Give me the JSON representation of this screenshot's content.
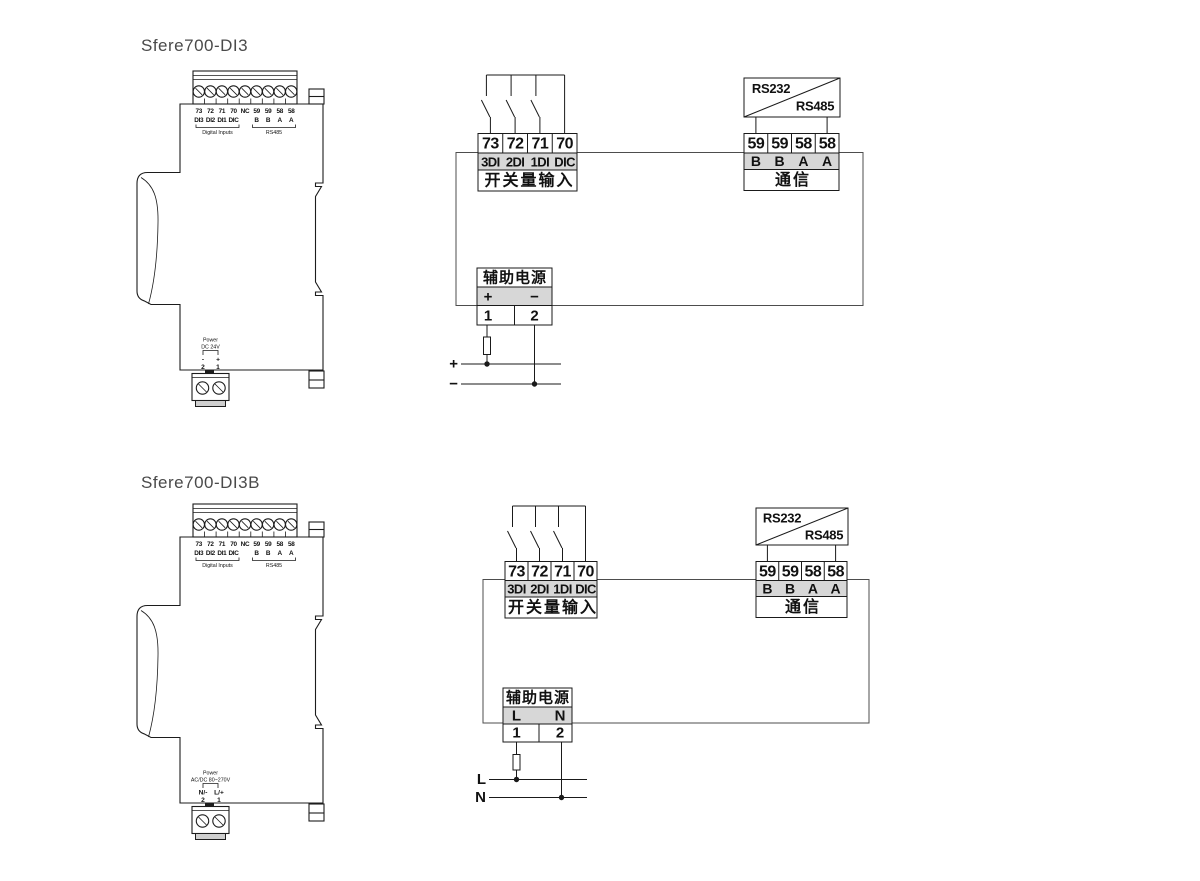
{
  "colors": {
    "ink": "#1a1a1a",
    "row_fill": "#d7d7d7",
    "frame": "#4d4d4d",
    "title_text": "#4a4a4a"
  },
  "sections": [
    {
      "title": "Sfere700-DI3",
      "device": {
        "terminals": [
          "73",
          "72",
          "71",
          "70",
          "NC",
          "59",
          "59",
          "58",
          "58"
        ],
        "signal_labels": [
          "DI3",
          "DI2",
          "DI1",
          "DIC",
          "B",
          "B",
          "A",
          "A"
        ],
        "group_left": "Digital Inputs",
        "group_right": "RS485",
        "power_title": "Power",
        "power_rating": "DC 24V",
        "power_polarity": [
          "-",
          "+"
        ],
        "power_terminals": [
          "2",
          "1"
        ]
      },
      "wiring": {
        "input_terminals": [
          "73",
          "72",
          "71",
          "70"
        ],
        "input_labels": [
          "3DI",
          "2DI",
          "1DI",
          "DIC"
        ],
        "input_caption": "开关量输入",
        "comm_converter_top": "RS232",
        "comm_converter_bottom": "RS485",
        "comm_terminals": [
          "59",
          "59",
          "58",
          "58"
        ],
        "comm_labels": [
          "B",
          "B",
          "A",
          "A"
        ],
        "comm_caption": "通信",
        "aux_caption": "辅助电源",
        "aux_row_labels": [
          "+",
          "−"
        ],
        "aux_terminals": [
          "1",
          "2"
        ],
        "supply_labels": [
          "+",
          "−"
        ]
      }
    },
    {
      "title": "Sfere700-DI3B",
      "device": {
        "terminals": [
          "73",
          "72",
          "71",
          "70",
          "NC",
          "59",
          "59",
          "58",
          "58"
        ],
        "signal_labels": [
          "DI3",
          "DI2",
          "DI1",
          "DIC",
          "B",
          "B",
          "A",
          "A"
        ],
        "group_left": "Digital Inputs",
        "group_right": "RS485",
        "power_title": "Power",
        "power_rating": "AC/DC 80~270V",
        "power_polarity": [
          "N/-",
          "L/+"
        ],
        "power_terminals": [
          "2",
          "1"
        ]
      },
      "wiring": {
        "input_terminals": [
          "73",
          "72",
          "71",
          "70"
        ],
        "input_labels": [
          "3DI",
          "2DI",
          "1DI",
          "DIC"
        ],
        "input_caption": "开关量输入",
        "comm_converter_top": "RS232",
        "comm_converter_bottom": "RS485",
        "comm_terminals": [
          "59",
          "59",
          "58",
          "58"
        ],
        "comm_labels": [
          "B",
          "B",
          "A",
          "A"
        ],
        "comm_caption": "通信",
        "aux_caption": "辅助电源",
        "aux_row_labels": [
          "L",
          "N"
        ],
        "aux_terminals": [
          "1",
          "2"
        ],
        "supply_labels": [
          "L",
          "N"
        ]
      }
    }
  ]
}
